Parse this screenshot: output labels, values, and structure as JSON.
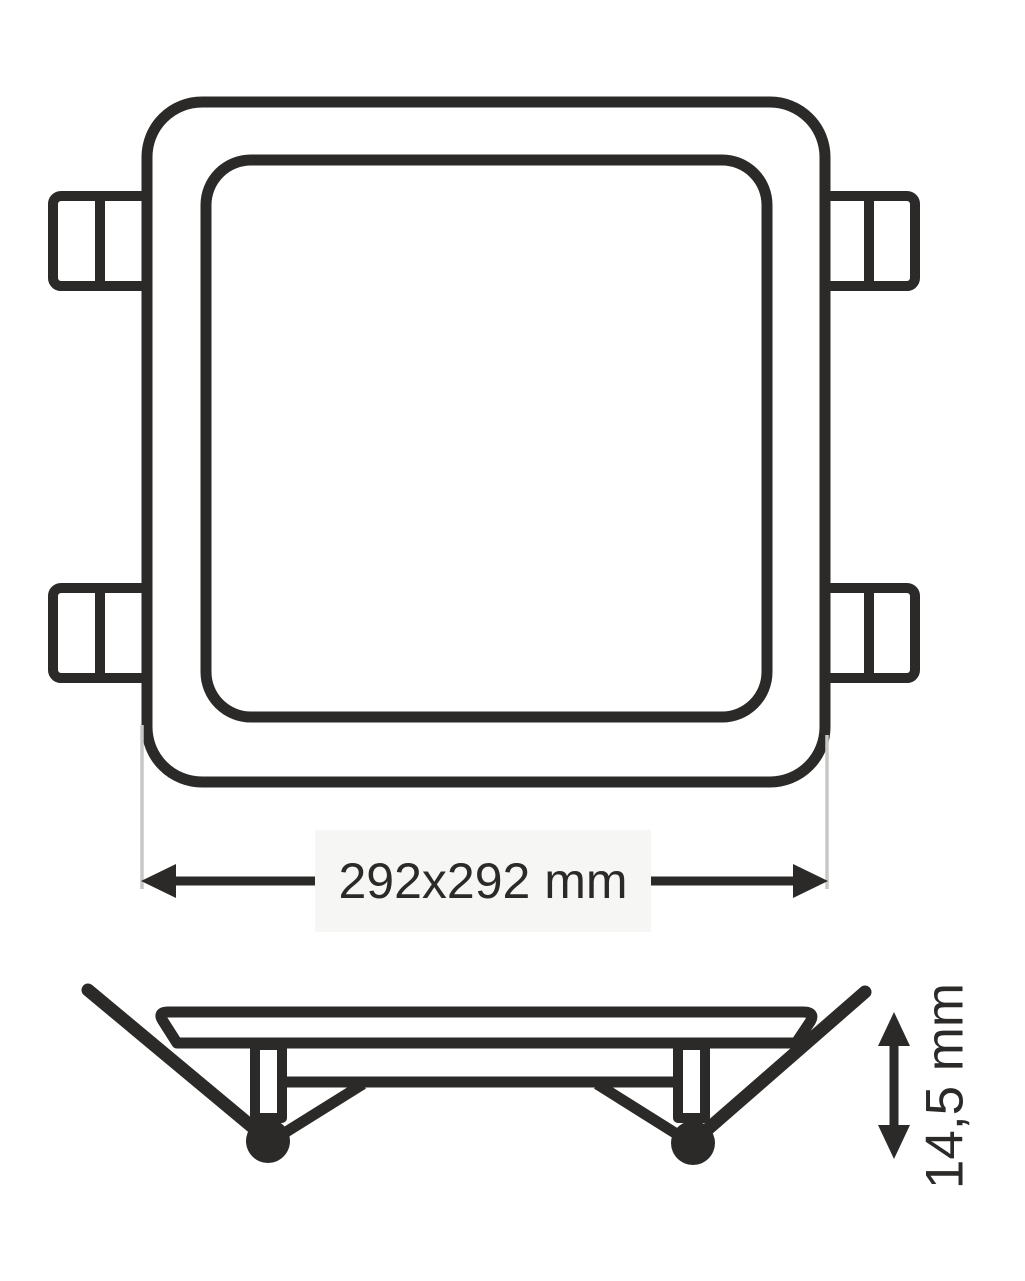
{
  "dimensions": {
    "width": {
      "label": "292x292 mm"
    },
    "height": {
      "label": "14,5 mm"
    }
  },
  "colors": {
    "ink": "#2b2a29",
    "extension-line": "#c7c7c5",
    "label-background": "#f6f6f4",
    "background": "#ffffff"
  }
}
